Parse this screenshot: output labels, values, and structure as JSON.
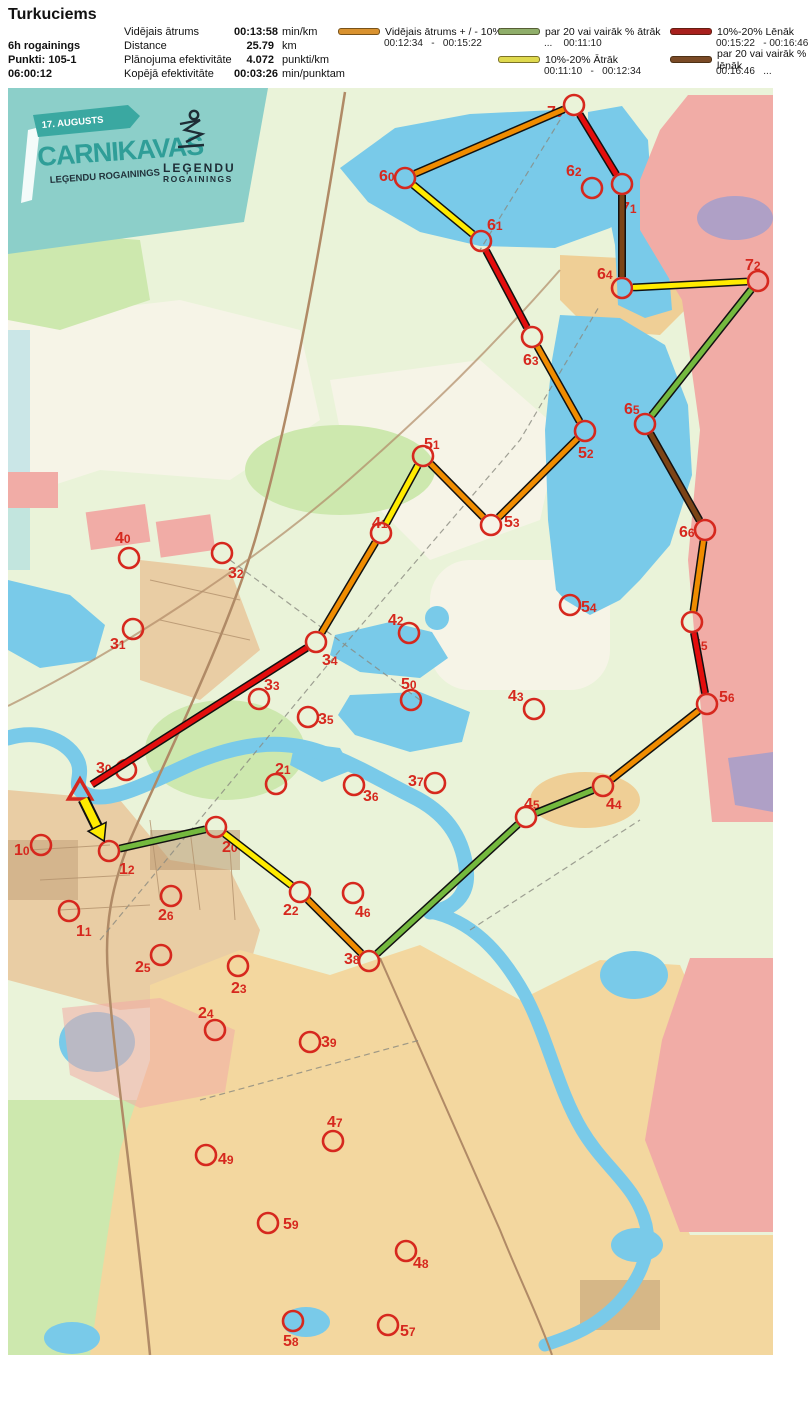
{
  "header": {
    "title": "Turkuciems",
    "meta_lines": [
      "6h rogainings",
      "Punkti: 105-1",
      "06:00:12"
    ],
    "stats": [
      {
        "label": "Vidējais ātrums",
        "value": "00:13:58",
        "unit": "min/km"
      },
      {
        "label": "Distance",
        "value": "25.79",
        "unit": "km"
      },
      {
        "label": "Plānojuma efektivitāte",
        "value": "4.072",
        "unit": "punkti/km"
      },
      {
        "label": "Kopējā efektivitāte",
        "value": "00:03:26",
        "unit": "min/punktam"
      }
    ],
    "legend_columns": [
      [
        {
          "color": "#D9922F",
          "label": "Vidējais ātrums + / - 10%",
          "range": "00:12:34   -   00:15:22"
        }
      ],
      [
        {
          "color": "#8FAE6A",
          "label": "par 20 vai vairāk % ātrāk",
          "range": "...    00:11:10"
        },
        {
          "color": "#DFD94E",
          "label": "10%-20% Ātrāk",
          "range": "00:11:10   -   00:12:34"
        }
      ],
      [
        {
          "color": "#A8201D",
          "label": "10%-20% Lēnāk",
          "range": "00:15:22   - 00:16:46"
        },
        {
          "color": "#7A4A26",
          "label": "par 20 vai vairāk % lēnāk",
          "range": "00:16:46   ..."
        }
      ]
    ]
  },
  "banner": {
    "date": "17. AUGUSTS",
    "title": "CARNIKAVAS",
    "subtitle": "LEĢENDU ROGAININGS",
    "logo_line1": "LEĢENDU",
    "logo_line2": "ROGAININGS",
    "bg_color": "#8CCFC9",
    "ribbon_color": "#3AA8A1"
  },
  "map": {
    "control_color": "#D6281E",
    "route_colors": {
      "orange": "#F08C00",
      "yellow": "#FFEB00",
      "green": "#74B93E",
      "red": "#E30D0D",
      "brown": "#7C4416"
    },
    "start": {
      "x": 80,
      "y": 792
    },
    "controls": [
      {
        "id": "70",
        "cx": 574,
        "cy": 105,
        "tx": 547,
        "ty": 117,
        "visited": true
      },
      {
        "id": "60",
        "cx": 405,
        "cy": 178,
        "tx": 379,
        "ty": 181,
        "visited": true
      },
      {
        "id": "62",
        "cx": 592,
        "cy": 188,
        "tx": 566,
        "ty": 176,
        "visited": false
      },
      {
        "id": "71",
        "cx": 622,
        "cy": 184,
        "tx": 621,
        "ty": 213,
        "visited": true
      },
      {
        "id": "61",
        "cx": 481,
        "cy": 241,
        "tx": 487,
        "ty": 230,
        "visited": true
      },
      {
        "id": "64",
        "cx": 622,
        "cy": 288,
        "tx": 597,
        "ty": 279,
        "visited": true
      },
      {
        "id": "72",
        "cx": 758,
        "cy": 281,
        "tx": 745,
        "ty": 270,
        "visited": true
      },
      {
        "id": "63",
        "cx": 532,
        "cy": 337,
        "tx": 523,
        "ty": 365,
        "visited": true
      },
      {
        "id": "65",
        "cx": 645,
        "cy": 424,
        "tx": 624,
        "ty": 414,
        "visited": true
      },
      {
        "id": "52",
        "cx": 585,
        "cy": 431,
        "tx": 578,
        "ty": 458,
        "visited": true
      },
      {
        "id": "51",
        "cx": 423,
        "cy": 456,
        "tx": 424,
        "ty": 449,
        "visited": true
      },
      {
        "id": "53",
        "cx": 491,
        "cy": 525,
        "tx": 504,
        "ty": 527,
        "visited": true
      },
      {
        "id": "41",
        "cx": 381,
        "cy": 533,
        "tx": 372,
        "ty": 528,
        "visited": true
      },
      {
        "id": "66",
        "cx": 705,
        "cy": 530,
        "tx": 679,
        "ty": 537,
        "visited": true
      },
      {
        "id": "40",
        "cx": 129,
        "cy": 558,
        "tx": 115,
        "ty": 543,
        "visited": false
      },
      {
        "id": "32",
        "cx": 222,
        "cy": 553,
        "tx": 228,
        "ty": 578,
        "visited": false
      },
      {
        "id": "54",
        "cx": 570,
        "cy": 605,
        "tx": 581,
        "ty": 612,
        "visited": false
      },
      {
        "id": "42",
        "cx": 409,
        "cy": 633,
        "tx": 388,
        "ty": 625,
        "visited": false
      },
      {
        "id": "31",
        "cx": 133,
        "cy": 629,
        "tx": 110,
        "ty": 649,
        "visited": false
      },
      {
        "id": "34",
        "cx": 316,
        "cy": 642,
        "tx": 322,
        "ty": 665,
        "visited": true
      },
      {
        "id": "55",
        "cx": 692,
        "cy": 622,
        "tx": 692,
        "ty": 650,
        "visited": true
      },
      {
        "id": "33",
        "cx": 259,
        "cy": 699,
        "tx": 264,
        "ty": 690,
        "visited": false
      },
      {
        "id": "50",
        "cx": 411,
        "cy": 700,
        "tx": 401,
        "ty": 689,
        "visited": false
      },
      {
        "id": "43",
        "cx": 534,
        "cy": 709,
        "tx": 508,
        "ty": 701,
        "visited": false
      },
      {
        "id": "56",
        "cx": 707,
        "cy": 704,
        "tx": 719,
        "ty": 702,
        "visited": true
      },
      {
        "id": "35",
        "cx": 308,
        "cy": 717,
        "tx": 318,
        "ty": 724,
        "visited": false
      },
      {
        "id": "21",
        "cx": 276,
        "cy": 784,
        "tx": 275,
        "ty": 774,
        "visited": false
      },
      {
        "id": "30",
        "cx": 126,
        "cy": 770,
        "tx": 96,
        "ty": 773,
        "visited": false
      },
      {
        "id": "36",
        "cx": 354,
        "cy": 785,
        "tx": 363,
        "ty": 801,
        "visited": false
      },
      {
        "id": "37",
        "cx": 435,
        "cy": 783,
        "tx": 408,
        "ty": 786,
        "visited": false
      },
      {
        "id": "45",
        "cx": 526,
        "cy": 817,
        "tx": 524,
        "ty": 809,
        "visited": true
      },
      {
        "id": "44",
        "cx": 603,
        "cy": 786,
        "tx": 606,
        "ty": 809,
        "visited": true
      },
      {
        "id": "10",
        "cx": 41,
        "cy": 845,
        "tx": 14,
        "ty": 855,
        "visited": false
      },
      {
        "id": "12",
        "cx": 109,
        "cy": 851,
        "tx": 119,
        "ty": 874,
        "visited": true
      },
      {
        "id": "20",
        "cx": 216,
        "cy": 827,
        "tx": 222,
        "ty": 852,
        "visited": true
      },
      {
        "id": "26",
        "cx": 171,
        "cy": 896,
        "tx": 158,
        "ty": 920,
        "visited": false
      },
      {
        "id": "22",
        "cx": 300,
        "cy": 892,
        "tx": 283,
        "ty": 915,
        "visited": true
      },
      {
        "id": "46",
        "cx": 353,
        "cy": 893,
        "tx": 355,
        "ty": 917,
        "visited": false
      },
      {
        "id": "11",
        "cx": 69,
        "cy": 911,
        "tx": 76,
        "ty": 936,
        "visited": false
      },
      {
        "id": "25",
        "cx": 161,
        "cy": 955,
        "tx": 135,
        "ty": 972,
        "visited": false
      },
      {
        "id": "38",
        "cx": 369,
        "cy": 961,
        "tx": 344,
        "ty": 964,
        "visited": true
      },
      {
        "id": "23",
        "cx": 238,
        "cy": 966,
        "tx": 231,
        "ty": 993,
        "visited": false
      },
      {
        "id": "24",
        "cx": 215,
        "cy": 1030,
        "tx": 198,
        "ty": 1018,
        "visited": false
      },
      {
        "id": "39",
        "cx": 310,
        "cy": 1042,
        "tx": 321,
        "ty": 1047,
        "visited": false
      },
      {
        "id": "47",
        "cx": 333,
        "cy": 1141,
        "tx": 327,
        "ty": 1127,
        "visited": false
      },
      {
        "id": "49",
        "cx": 206,
        "cy": 1155,
        "tx": 218,
        "ty": 1164,
        "visited": false
      },
      {
        "id": "59",
        "cx": 268,
        "cy": 1223,
        "tx": 283,
        "ty": 1229,
        "visited": false
      },
      {
        "id": "48",
        "cx": 406,
        "cy": 1251,
        "tx": 413,
        "ty": 1268,
        "visited": false
      },
      {
        "id": "58",
        "cx": 293,
        "cy": 1321,
        "tx": 283,
        "ty": 1346,
        "visited": false
      },
      {
        "id": "57",
        "cx": 388,
        "cy": 1325,
        "tx": 400,
        "ty": 1336,
        "visited": false
      }
    ],
    "route_legs": [
      {
        "from": "start",
        "to": "12",
        "color": "yellow",
        "arrow": true
      },
      {
        "from": "12",
        "to": "20",
        "color": "green"
      },
      {
        "from": "20",
        "to": "22",
        "color": "yellow"
      },
      {
        "from": "22",
        "to": "38",
        "color": "orange"
      },
      {
        "from": "38",
        "to": "45",
        "color": "green"
      },
      {
        "from": "45",
        "to": "44",
        "color": "green"
      },
      {
        "from": "44",
        "to": "56",
        "color": "orange"
      },
      {
        "from": "56",
        "to": "55",
        "color": "red"
      },
      {
        "from": "55",
        "to": "66",
        "color": "orange"
      },
      {
        "from": "66",
        "to": "65",
        "color": "brown"
      },
      {
        "from": "65",
        "to": "72",
        "color": "green"
      },
      {
        "from": "72",
        "to": "64",
        "color": "yellow"
      },
      {
        "from": "64",
        "to": "71",
        "color": "brown"
      },
      {
        "from": "71",
        "to": "70",
        "color": "red"
      },
      {
        "from": "70",
        "to": "60",
        "color": "orange"
      },
      {
        "from": "60",
        "to": "61",
        "color": "yellow"
      },
      {
        "from": "61",
        "to": "63",
        "color": "red"
      },
      {
        "from": "63",
        "to": "52",
        "color": "orange"
      },
      {
        "from": "52",
        "to": "53",
        "color": "orange"
      },
      {
        "from": "53",
        "to": "51",
        "color": "orange"
      },
      {
        "from": "51",
        "to": "41",
        "color": "yellow"
      },
      {
        "from": "41",
        "to": "34",
        "color": "orange"
      },
      {
        "from": "34",
        "to": "start",
        "color": "red"
      }
    ]
  }
}
